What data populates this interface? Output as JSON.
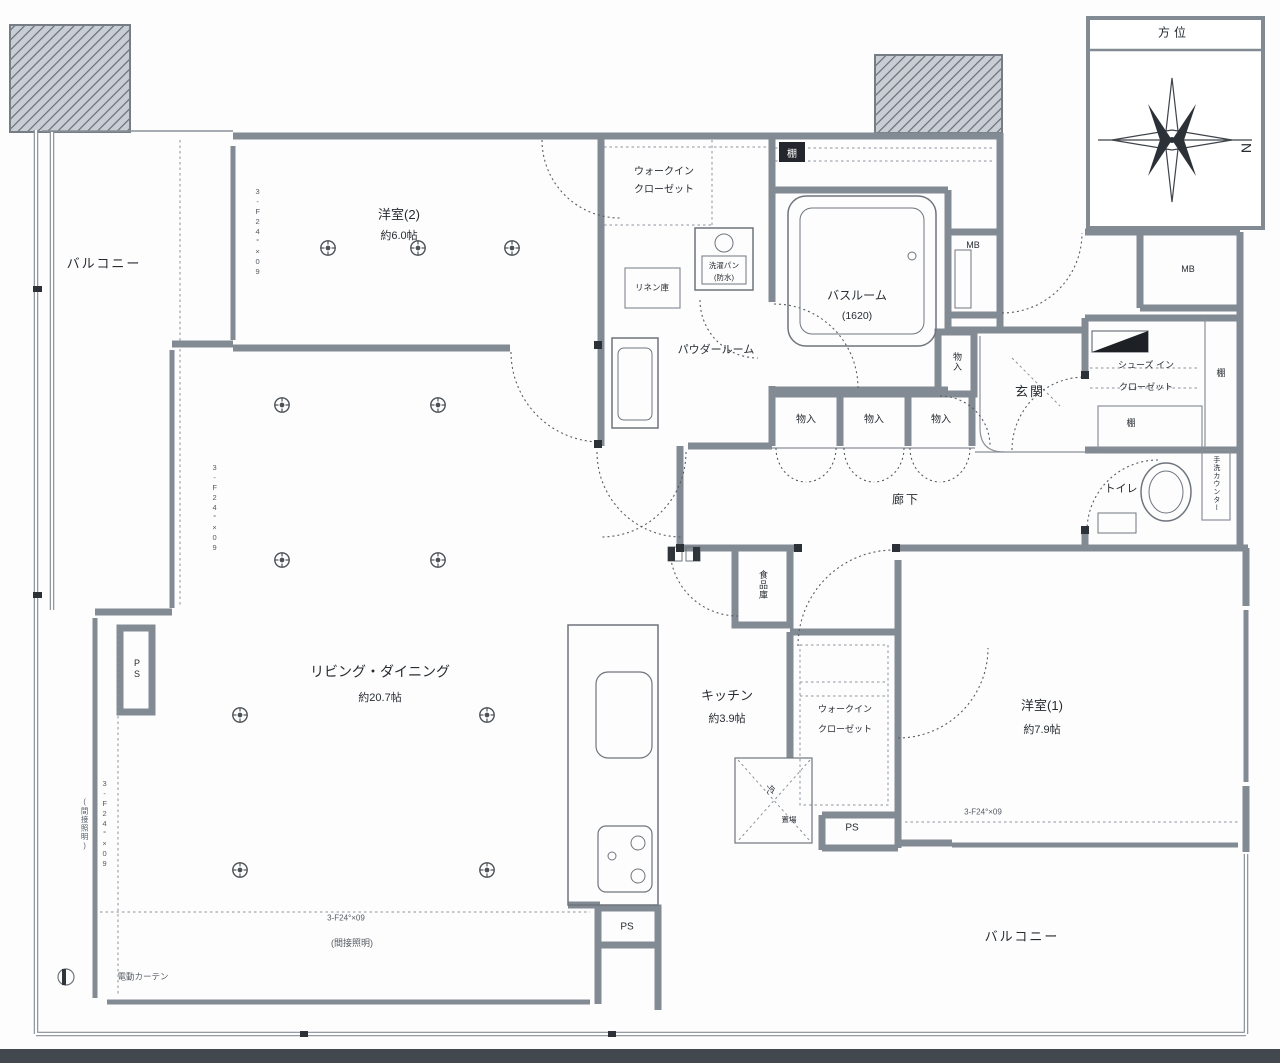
{
  "compass": {
    "title": "方位",
    "north": "N"
  },
  "rooms": {
    "balcony_left": "バルコニー",
    "balcony_bottom": "バルコニー",
    "western2": {
      "name": "洋室(2)",
      "size": "約6.0帖"
    },
    "living": {
      "name": "リビング・ダイニング",
      "size": "約20.7帖"
    },
    "kitchen": {
      "name": "キッチン",
      "size": "約3.9帖"
    },
    "western1": {
      "name": "洋室(1)",
      "size": "約7.9帖"
    },
    "bath": {
      "name": "バスルーム",
      "size": "(1620)"
    },
    "powder": "パウダールーム",
    "wic": {
      "line1": "ウォークイン",
      "line2": "クローゼット"
    },
    "sic": {
      "line1": "シューズ イン",
      "line2": "クローゼット"
    },
    "genkan": "玄関",
    "toilet": "トイレ",
    "corridor": "廊下",
    "pantry": "食品庫",
    "linen": "リネン庫",
    "laundry": {
      "line1": "洗濯パン",
      "line2": "(防水)"
    }
  },
  "labels": {
    "mb": "MB",
    "ps": "PS",
    "shelf": "棚",
    "storage": "物入",
    "fridge": "冷",
    "fridge_place": "置場",
    "handwash_counter": "手洗カウンター",
    "indirect_lighting": "(間接照明)",
    "electric_curtain": "電動カーテン",
    "sash_code": "3-F24°×09"
  }
}
